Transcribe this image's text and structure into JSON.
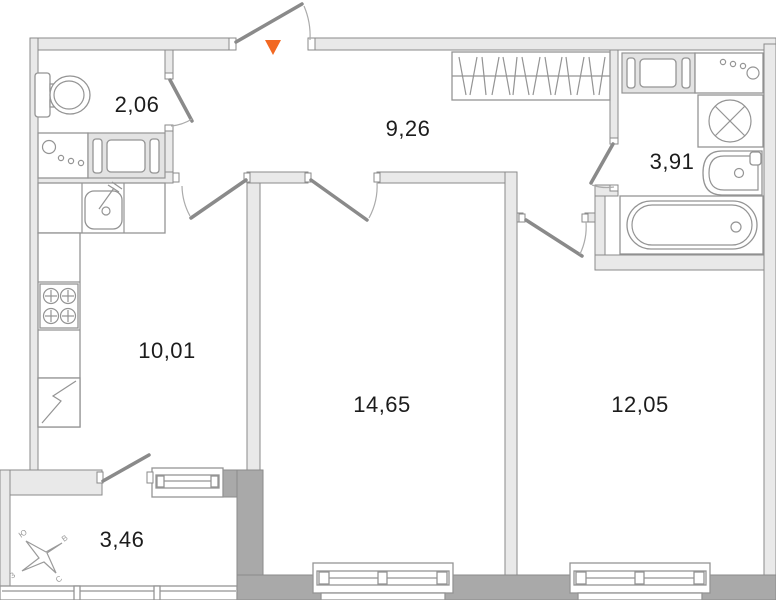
{
  "plan": {
    "type": "apartment-floor-plan",
    "rooms": [
      {
        "id": "wc",
        "area": "2,06"
      },
      {
        "id": "hallway",
        "area": "9,26"
      },
      {
        "id": "bathroom",
        "area": "3,91"
      },
      {
        "id": "kitchen",
        "area": "10,01"
      },
      {
        "id": "living-room",
        "area": "14,65"
      },
      {
        "id": "bedroom",
        "area": "12,05"
      },
      {
        "id": "balcony",
        "area": "3,46"
      }
    ],
    "compass": {
      "n": "С",
      "s": "Ю",
      "e": "В",
      "w": "З"
    },
    "icons": {
      "entrance_marker": "triangle-down",
      "washing_machine": "circle-with-x",
      "fridge": "rect-with-zigzag",
      "wardrobe": "hatched-rect"
    },
    "colors": {
      "entrance_marker": "#F26822",
      "wall_light": "#E9E9E9",
      "wall_dark": "#A9A9A9",
      "line": "#949494",
      "text": "#1C1C1C"
    }
  }
}
